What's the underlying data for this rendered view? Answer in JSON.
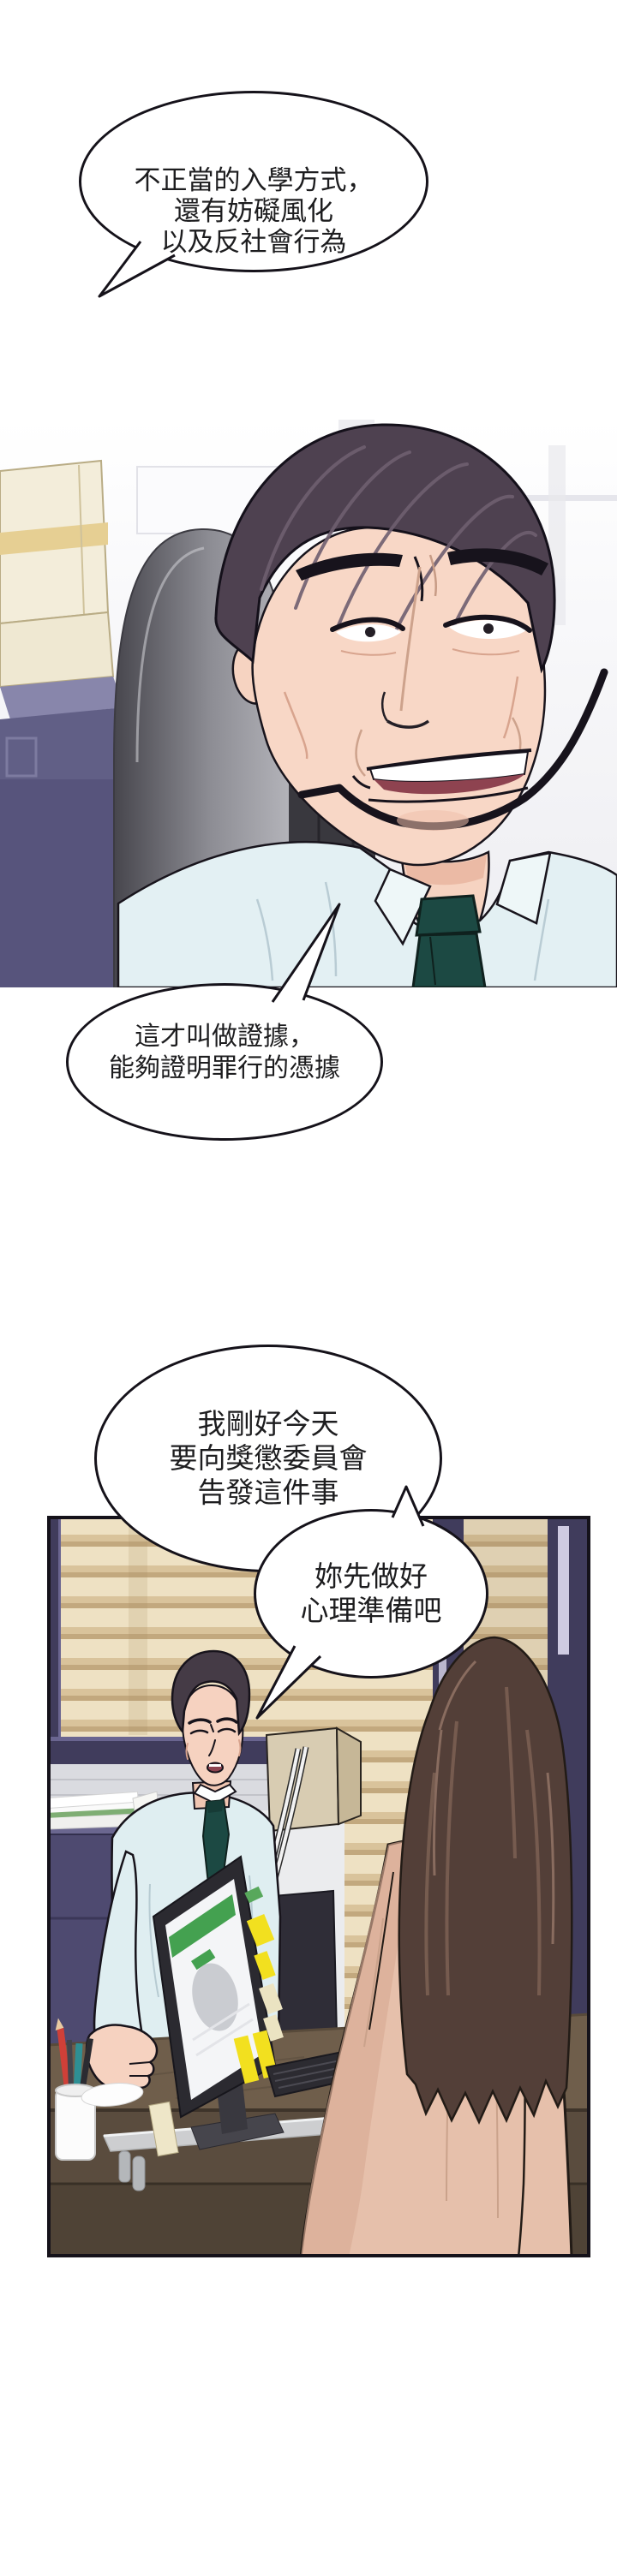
{
  "page": {
    "kind": "comic-page",
    "ink": "#15121a",
    "paper": "#ffffff"
  },
  "bubbles": {
    "b1": {
      "lines": [
        "不正當的入學方式，",
        "還有妨礙風化",
        "以及反社會行為"
      ]
    },
    "b2": {
      "lines": [
        "這才叫做證據，",
        "能夠證明罪行的憑據"
      ]
    },
    "b3": {
      "lines": [
        "我剛好今天",
        "要向獎懲委員會",
        "告發這件事"
      ]
    },
    "b4": {
      "lines": [
        "妳先做好",
        "心理準備吧"
      ]
    }
  },
  "palette": {
    "shirt_blue": "#e3f0f3",
    "tie_teal": "#1c4943",
    "suit_navy": "#57547c",
    "chair_gray": "#8d8d94",
    "blinds_tan": "#eee1c3",
    "window_frame_navy": "#403c5c",
    "desk_brown": "#6f5e4b",
    "monitor_green": "#44a150",
    "sticky_yellow": "#f2e01f",
    "woman_hair_brown": "#533f38",
    "woman_coat_tan": "#e6c0ab",
    "skin": "#f6d3c1"
  }
}
